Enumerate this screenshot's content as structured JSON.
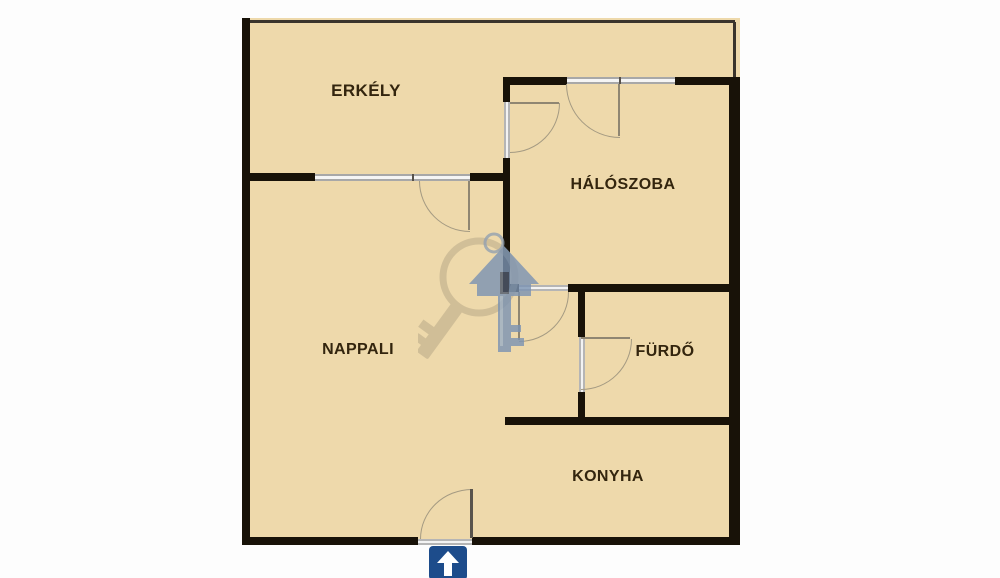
{
  "title": "Apartment floor plan",
  "floorplan": {
    "rooms": [
      {
        "id": "erkely",
        "label": "ERKÉLY"
      },
      {
        "id": "haloszoba",
        "label": "HÁLÓSZOBA"
      },
      {
        "id": "nappali",
        "label": "NAPPALI"
      },
      {
        "id": "furdo",
        "label": "FÜRDŐ"
      },
      {
        "id": "konyha",
        "label": "KONYHA"
      }
    ],
    "entrance": {
      "icon": "up-arrow-icon"
    },
    "watermark": {
      "icon": "keys-watermark-icon"
    },
    "colors": {
      "floor": "#eed9ab",
      "wall": "#181208",
      "window": "#a8a8a8",
      "door_arc": "#a49a82",
      "entrance_sign": "#1d4c8b",
      "watermark_gray": "#b4a585",
      "watermark_blue": "#7b93b3",
      "label_text": "#33250e"
    }
  }
}
